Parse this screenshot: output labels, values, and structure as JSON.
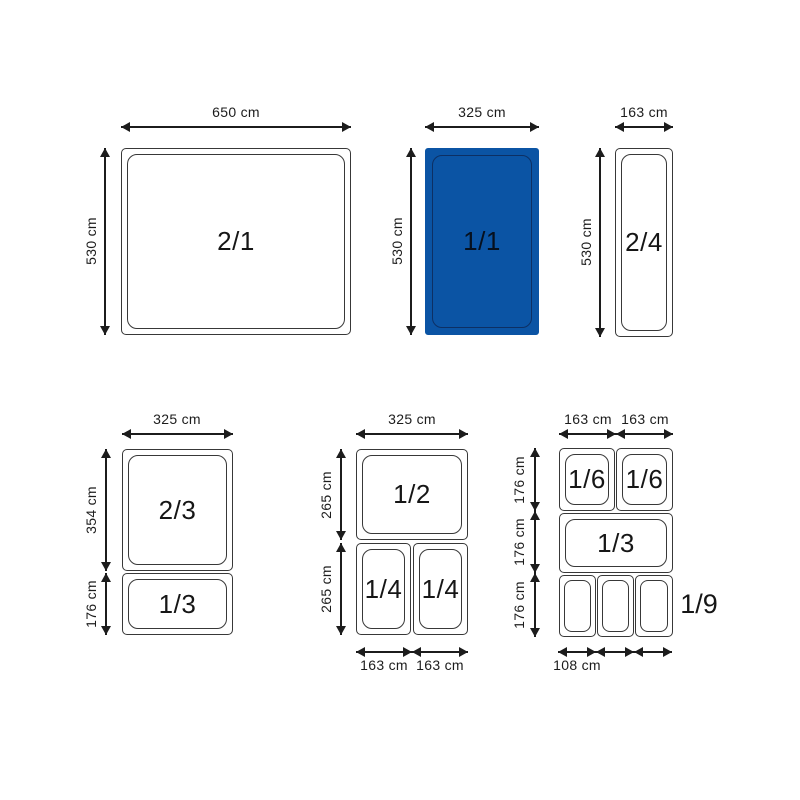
{
  "colors": {
    "highlight_fill": "#0B54A4",
    "highlight_inner_line": "#0D3064",
    "line": "#1C1C1C"
  },
  "groups": {
    "gn21": {
      "pan": "2/1",
      "width": "650 cm",
      "height": "530 cm"
    },
    "gn11": {
      "pan": "1/1",
      "width": "325 cm",
      "height": "530 cm"
    },
    "gn24": {
      "pan": "2/4",
      "width": "163 cm",
      "height": "530 cm"
    },
    "gn23": {
      "width": "325 cm",
      "pan1": "2/3",
      "pan1_height": "354 cm",
      "pan2": "1/3",
      "pan2_height": "176 cm"
    },
    "gn12": {
      "width": "325 cm",
      "pan1": "1/2",
      "row1_height": "265 cm",
      "row2_height": "265 cm",
      "pan2": "1/4",
      "pan3": "1/4",
      "pan2_width": "163 cm",
      "pan3_width": "163 cm"
    },
    "gn69": {
      "col1_width": "163 cm",
      "col2_width": "163 cm",
      "row1_height": "176 cm",
      "row2_height": "176 cm",
      "row3_height": "176 cm",
      "pan1": "1/6",
      "pan2": "1/6",
      "pan3": "1/3",
      "row3_label": "1/9",
      "row3_cell_width": "108 cm"
    }
  }
}
